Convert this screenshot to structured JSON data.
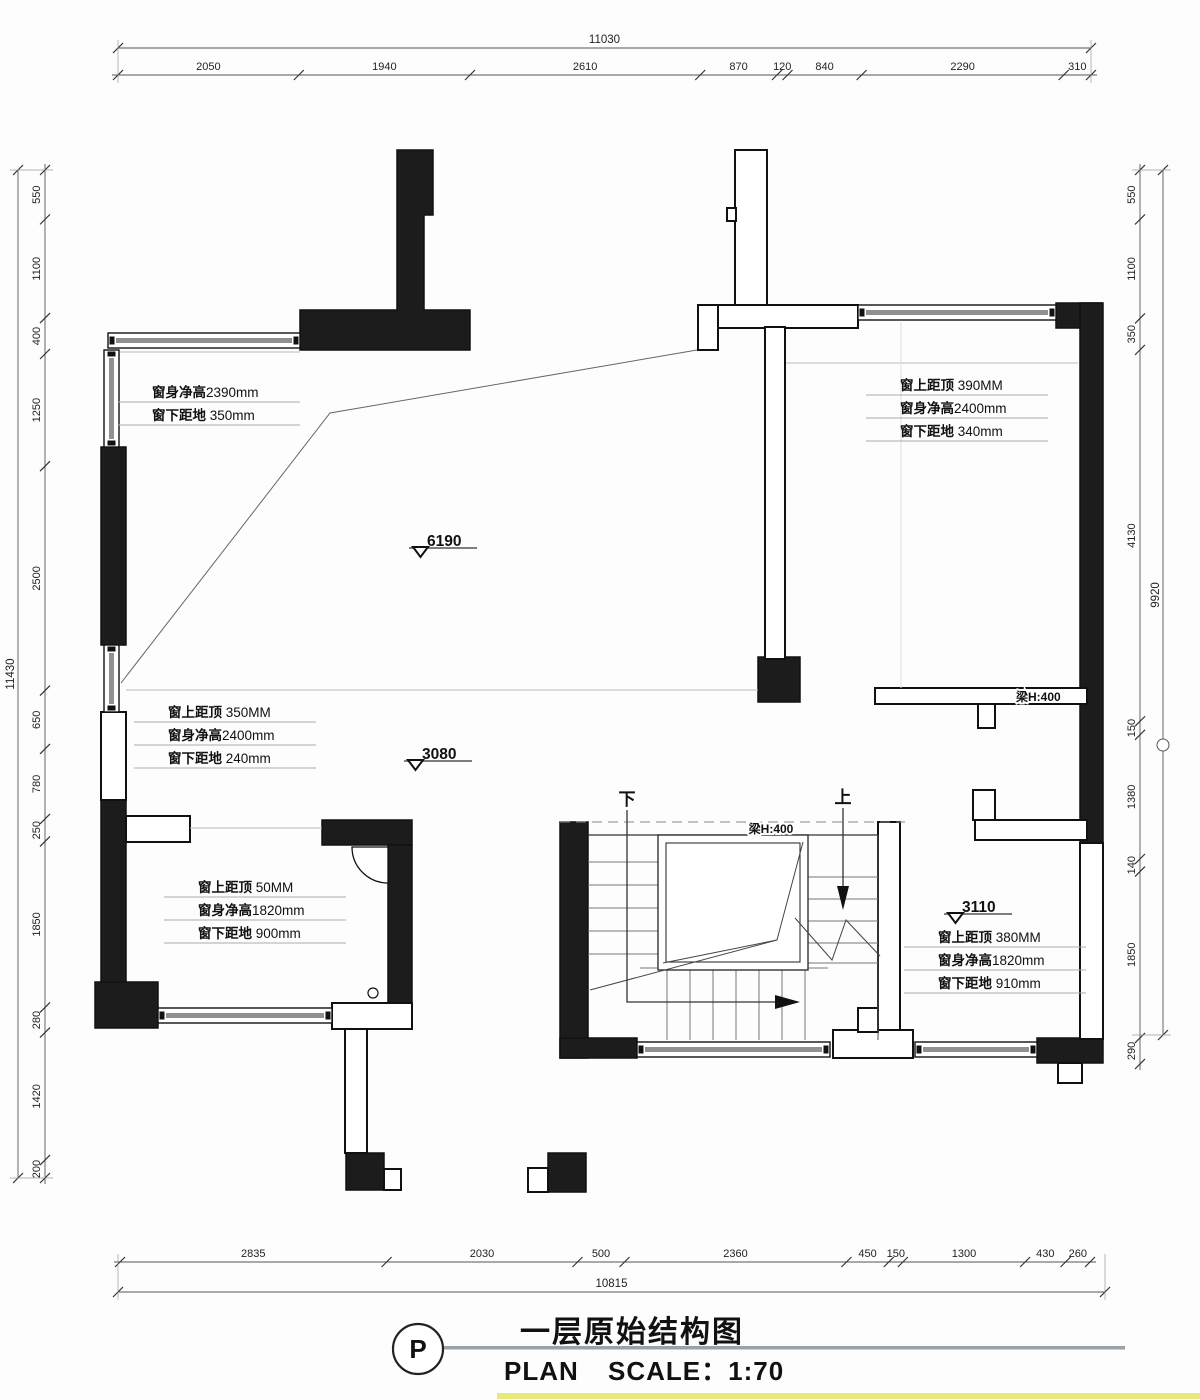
{
  "title_block": {
    "tag": "P",
    "title": "一层原始结构图",
    "plan": "PLAN",
    "scale": "SCALE：1:70"
  },
  "dimensions": {
    "top": {
      "total": "11030",
      "segments": [
        "2050",
        "1940",
        "2610",
        "870",
        "120",
        "840",
        "2290",
        "310"
      ]
    },
    "bottom": {
      "total": "10815",
      "segments": [
        "2835",
        "2030",
        "500",
        "2360",
        "450",
        "150",
        "1300",
        "430",
        "260"
      ]
    },
    "left": {
      "total": "11430",
      "segments": [
        "550",
        "1100",
        "400",
        "1250",
        "2500",
        "650",
        "780",
        "250",
        "1850",
        "280",
        "1420",
        "200"
      ]
    },
    "right": {
      "total": "9920",
      "segments": [
        "550",
        "1100",
        "350",
        "4130",
        "150",
        "1380",
        "140",
        "1850",
        "290"
      ]
    }
  },
  "window_notes": [
    {
      "id": "top-left",
      "lines": [
        {
          "b": "窗身净高",
          "r": "2390mm"
        },
        {
          "b": "窗下距地",
          "r": " 350mm"
        }
      ]
    },
    {
      "id": "top-right",
      "lines": [
        {
          "b": "窗上距顶",
          "r": " 390MM"
        },
        {
          "b": "窗身净高",
          "r": "2400mm"
        },
        {
          "b": "窗下距地",
          "r": " 340mm"
        }
      ]
    },
    {
      "id": "mid-left",
      "lines": [
        {
          "b": "窗上距顶",
          "r": " 350MM"
        },
        {
          "b": "窗身净高",
          "r": "2400mm"
        },
        {
          "b": "窗下距地",
          "r": " 240mm"
        }
      ]
    },
    {
      "id": "bottom-left",
      "lines": [
        {
          "b": "窗上距顶",
          "r": "  50MM"
        },
        {
          "b": "窗身净高",
          "r": "1820mm"
        },
        {
          "b": "窗下距地",
          "r": " 900mm"
        }
      ]
    },
    {
      "id": "bottom-right",
      "lines": [
        {
          "b": "窗上距顶",
          "r": " 380MM"
        },
        {
          "b": "窗身净高",
          "r": "1820mm"
        },
        {
          "b": "窗下距地",
          "r": " 910mm"
        }
      ]
    }
  ],
  "level_marks": [
    "6190",
    "3080",
    "3110"
  ],
  "beam_labels": [
    "梁H:400",
    "梁H:400"
  ],
  "stair_labels": {
    "down": "下",
    "up": "上"
  },
  "colors": {
    "wall": "#1c1c1c",
    "outline": "#111111",
    "dim_line": "#555555",
    "thin_line": "#bbbbbb",
    "window_band": "#909090",
    "title_rule": "#99a1ad",
    "bottom_bar": "#e9e97b"
  }
}
